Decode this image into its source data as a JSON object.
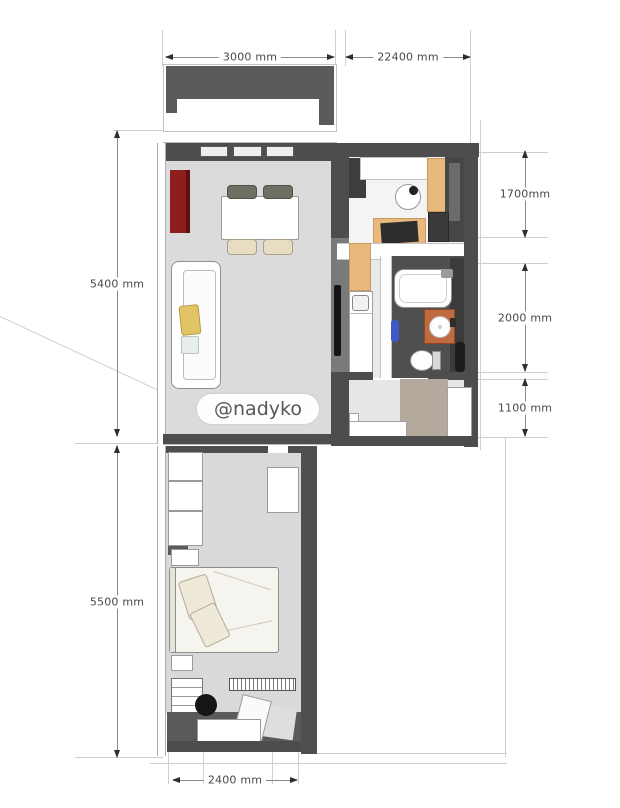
{
  "watermark": "@nadyko",
  "dimensions": {
    "top_left": "3000 mm",
    "top_right": "22400 mm",
    "right_upper": "1700mm",
    "right_middle": "2000 mm",
    "right_lower": "1100 mm",
    "left_upper": "5400 mm",
    "left_lower": "5500 mm",
    "bottom": "2400 mm"
  },
  "colors": {
    "wall_dark": "#4d4d4d",
    "wall_mid": "#7a7a7a",
    "floor_living": "#dbdbdb",
    "floor_bedroom": "#d9d9d9",
    "cabinet_red": "#8e1d1d",
    "cabinet_orange": "#e9b87c",
    "vanity_terracotta": "#c06a42",
    "rug_taupe": "#b3aa9d",
    "pillow_yellow": "#e3c465",
    "accent_blue": "#3f5ac8",
    "chair_olive": "#6e6e62",
    "chair_cream": "#e7ddc3",
    "guide_line": "#cfcfcf",
    "dimension_text": "#4a4a4a"
  }
}
